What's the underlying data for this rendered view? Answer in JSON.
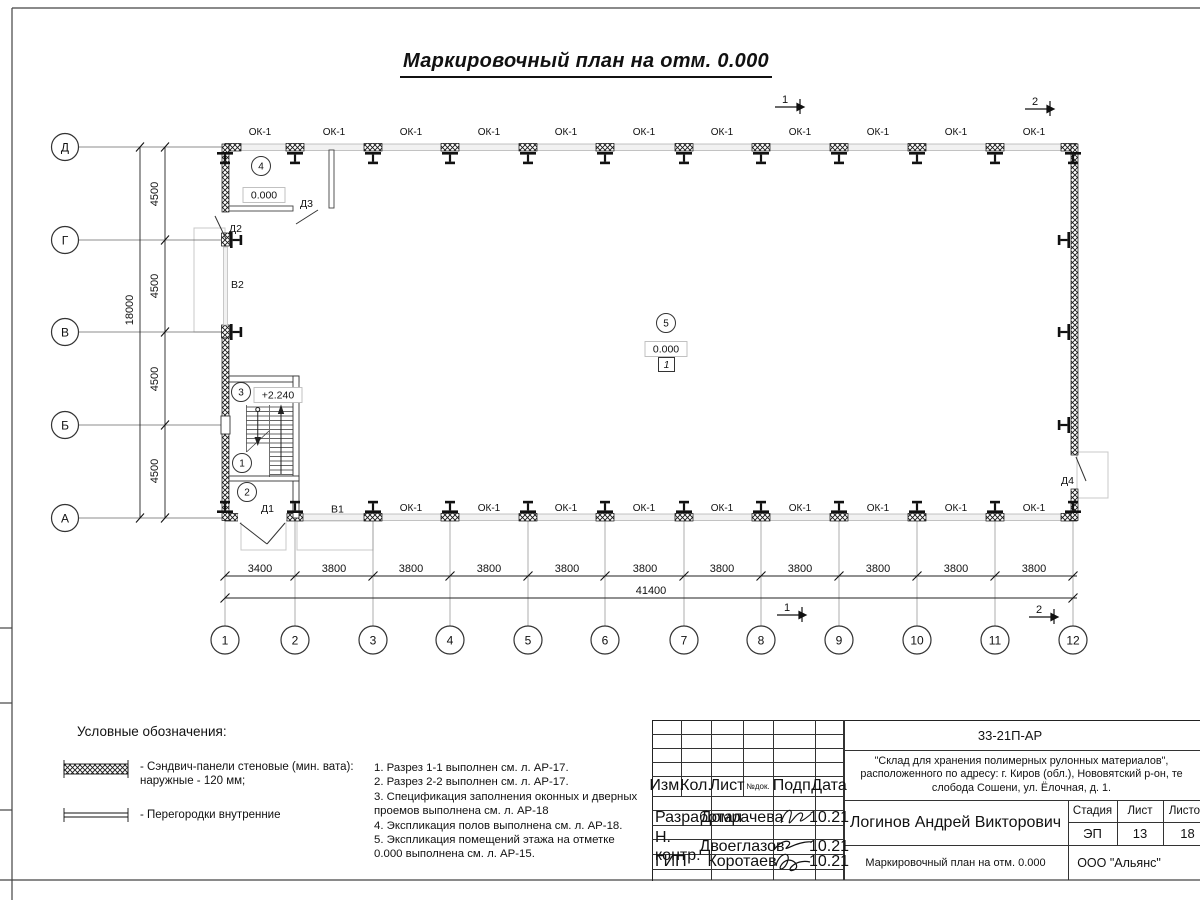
{
  "title": "Маркировочный план на отм. 0.000",
  "plan": {
    "window_label": "ОК-1",
    "axes_letters": [
      "Д",
      "Г",
      "В",
      "Б",
      "А"
    ],
    "axes_numbers": [
      "1",
      "2",
      "3",
      "4",
      "5",
      "6",
      "7",
      "8",
      "9",
      "10",
      "11",
      "12"
    ],
    "rooms": {
      "r1": "1",
      "r2": "2",
      "r3": "3",
      "r4": "4",
      "r5": "5"
    },
    "marks": {
      "zero": "0.000",
      "mezzanine": "+2.240",
      "floor_type": "1"
    },
    "doors": {
      "d1": "Д1",
      "d2": "Д2",
      "d3": "Д3",
      "d4": "Д4",
      "g1": "В1",
      "g2": "В2"
    },
    "sections": {
      "s1": "1",
      "s2": "2"
    },
    "dims": {
      "bay_first": "3400",
      "bay": "3800",
      "total": "41400",
      "row": "4500",
      "total_v": "18000"
    }
  },
  "legend": {
    "heading": "Условные обозначения:",
    "item1_line1": "- Сэндвич-панели стеновые (мин. вата):",
    "item1_line2": "наружные - 120 мм;",
    "item2": "- Перегородки внутренние"
  },
  "notes": [
    "1. Разрез 1-1 выполнен см. л. АР-17.",
    "2. Разрез 2-2 выполнен см. л. АР-17.",
    "3. Спецификация заполнения оконных и дверных",
    "проемов выполнена см. л. АР-18",
    "4. Экспликация полов выполнена см. л. АР-18.",
    "5. Экспликация помещений этажа на отметке",
    "0.000 выполнена см. л. АР-15."
  ],
  "titleblock": {
    "doc_code": "33-21П-АР",
    "project_line1": "\"Склад для хранения полимерных рулонных материалов\",",
    "project_line2": "расположенного по адресу: г. Киров (обл.), Нововятский р-он, те",
    "project_line3": "слобода Сошени, ул. Ёлочная, д. 1.",
    "cols": {
      "izm": "Изм.",
      "kol": "Кол.",
      "list": "Лист",
      "ndoc": "№док.",
      "podp": "Подп.",
      "data": "Дата"
    },
    "rows": [
      {
        "role": "Разработал",
        "name": "Домрачева",
        "date": "10.21"
      },
      {
        "role": "Н. контр.",
        "name": "Двоеглазов",
        "date": "10.21"
      },
      {
        "role": "ГИП",
        "name": "Коротаев",
        "date": "10.21"
      }
    ],
    "author": "Логинов Андрей Викторович",
    "stage_label": "Стадия",
    "sheet_label": "Лист",
    "sheets_label": "Листов",
    "stage": "ЭП",
    "sheet": "13",
    "sheets": "18",
    "drawing_name": "Маркировочный план на отм. 0.000",
    "company": "ООО \"Альянс\""
  }
}
